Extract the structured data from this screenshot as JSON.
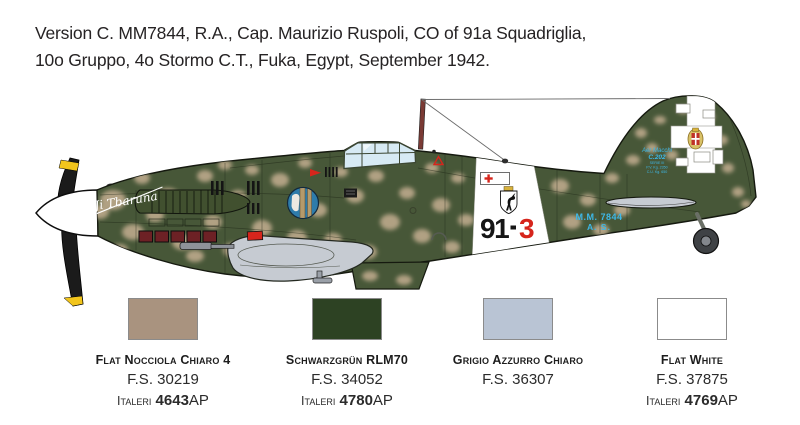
{
  "header": {
    "line1": "Version C. MM7844, R.A., Cap. Maurizio Ruspoli, CO of 91a Squadriglia,",
    "line2": "10o Gruppo, 4o Stormo C.T., Fuka, Egypt, September 1942."
  },
  "aircraft": {
    "nose_art": "Ji Tbaruna",
    "code_left": "91",
    "code_right": "3",
    "serial_line1": "M.M. 7844",
    "serial_line2": "A. S.",
    "fin_stencil": {
      "line1": "Aer Macchi",
      "line2": "C.202",
      "line3": "SERIE III",
      "line4": "P.V. Kg. 2350",
      "line5": "C.U. Kg. 650"
    },
    "colors": {
      "camo_green": "#475738",
      "camo_tan": "#b1a183",
      "underside_gray": "#c6cbd2",
      "marking_red": "#d6251c",
      "stencil_blue": "#3db8e8",
      "prop_yellow": "#f2c51c",
      "exhaust_red": "#6d2125",
      "outline": "#15190f"
    },
    "camo_blotches": [
      [
        100,
        212,
        9,
        7
      ],
      [
        113,
        200,
        13,
        10
      ],
      [
        133,
        232,
        11,
        8
      ],
      [
        142,
        178,
        8,
        6
      ],
      [
        155,
        215,
        9,
        7
      ],
      [
        168,
        196,
        11,
        8
      ],
      [
        182,
        242,
        10,
        8
      ],
      [
        195,
        256,
        9,
        6
      ],
      [
        205,
        176,
        8,
        6
      ],
      [
        213,
        222,
        9,
        7
      ],
      [
        225,
        165,
        7,
        5
      ],
      [
        232,
        250,
        9,
        7
      ],
      [
        238,
        196,
        8,
        6
      ],
      [
        252,
        170,
        7,
        5
      ],
      [
        262,
        228,
        10,
        8
      ],
      [
        280,
        180,
        9,
        7
      ],
      [
        297,
        238,
        10,
        8
      ],
      [
        305,
        163,
        7,
        5
      ],
      [
        318,
        210,
        9,
        7
      ],
      [
        333,
        240,
        9,
        7
      ],
      [
        341,
        172,
        7,
        5
      ],
      [
        355,
        196,
        9,
        7
      ],
      [
        368,
        252,
        9,
        7
      ],
      [
        376,
        176,
        8,
        6
      ],
      [
        390,
        222,
        10,
        8
      ],
      [
        402,
        158,
        6,
        4
      ],
      [
        407,
        193,
        8,
        6
      ],
      [
        422,
        236,
        9,
        7
      ],
      [
        432,
        168,
        7,
        5
      ],
      [
        441,
        205,
        9,
        7
      ],
      [
        452,
        247,
        8,
        6
      ],
      [
        458,
        178,
        7,
        5
      ],
      [
        466,
        220,
        8,
        6
      ],
      [
        560,
        186,
        9,
        7
      ],
      [
        572,
        222,
        9,
        7
      ],
      [
        588,
        200,
        8,
        6
      ],
      [
        601,
        230,
        8,
        6
      ],
      [
        612,
        178,
        7,
        5
      ],
      [
        622,
        210,
        8,
        6
      ],
      [
        633,
        160,
        7,
        5
      ],
      [
        641,
        133,
        6,
        5
      ],
      [
        652,
        148,
        6,
        5
      ],
      [
        660,
        120,
        6,
        4
      ],
      [
        672,
        155,
        6,
        5
      ],
      [
        683,
        110,
        6,
        4
      ],
      [
        700,
        160,
        7,
        5
      ],
      [
        710,
        117,
        5,
        4
      ],
      [
        722,
        140,
        6,
        5
      ],
      [
        728,
        168,
        6,
        5
      ],
      [
        738,
        192,
        6,
        5
      ],
      [
        746,
        204,
        5,
        4
      ],
      [
        370,
        276,
        8,
        5
      ],
      [
        404,
        280,
        8,
        5
      ],
      [
        120,
        250,
        8,
        6
      ]
    ]
  },
  "swatches": [
    {
      "name": "Flat Nocciola Chiaro 4",
      "fs": "F.S. 30219",
      "brand": "Italeri",
      "code": "4643",
      "suffix": "AP",
      "hex": "#a9937f"
    },
    {
      "name": "Schwarzgrün RLM70",
      "fs": "F.S. 34052",
      "brand": "Italeri",
      "code": "4780",
      "suffix": "AP",
      "hex": "#2d4223"
    },
    {
      "name": "Grigio Azzurro Chiaro",
      "fs": "F.S. 36307",
      "brand": "",
      "code": "",
      "suffix": "",
      "hex": "#b9c4d4"
    },
    {
      "name": "Flat White",
      "fs": "F.S. 37875",
      "brand": "Italeri",
      "code": "4769",
      "suffix": "AP",
      "hex": "#ffffff"
    }
  ]
}
